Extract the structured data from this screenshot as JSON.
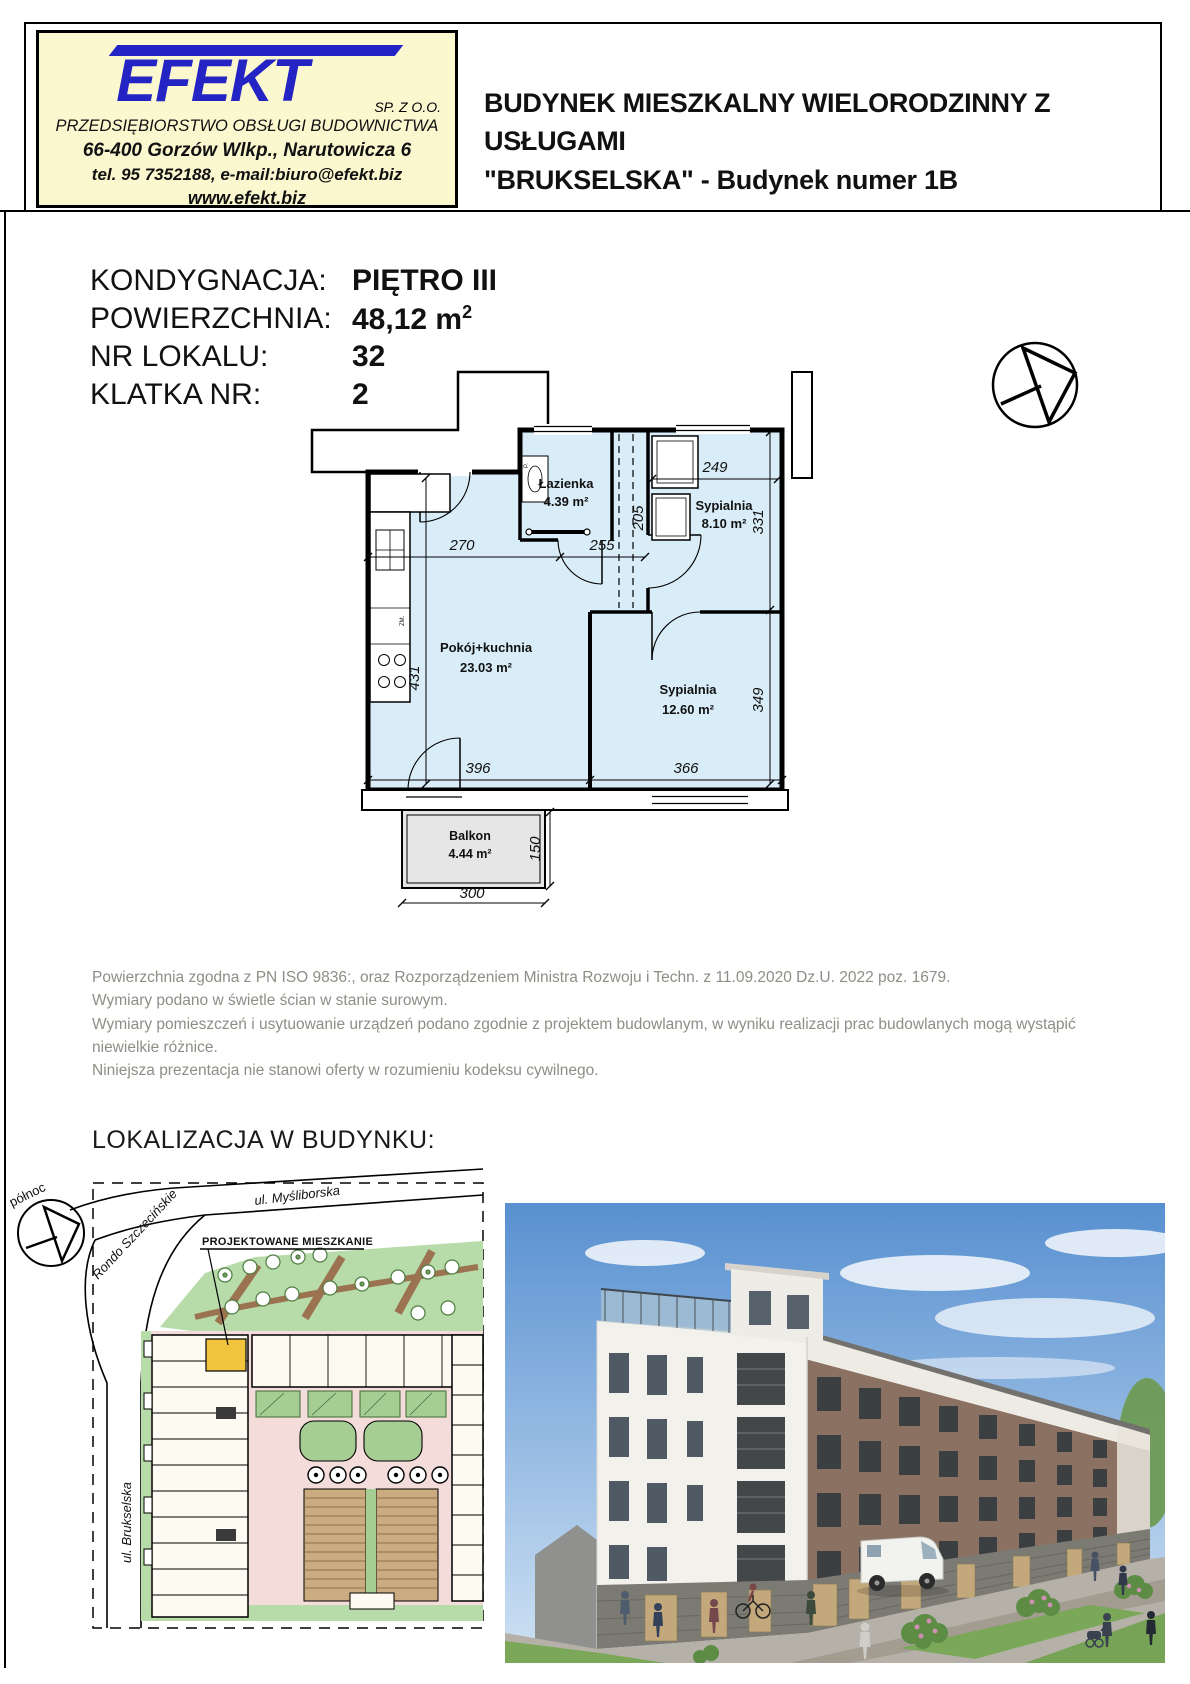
{
  "logo_box": {
    "company": "EFEKT",
    "legal": "SP. Z O.O.",
    "subtitle": "PRZEDSIĘBIORSTWO OBSŁUGI BUDOWNICTWA",
    "address": "66-400 Gorzów Wlkp., Narutowicza 6",
    "contact": "tel. 95 7352188, e-mail:biuro@efekt.biz",
    "website": "www.efekt.biz"
  },
  "header": {
    "title_line1": "BUDYNEK MIESZKALNY WIELORODZINNY Z USŁUGAMI",
    "title_line2": "\"BRUKSELSKA\" - Budynek numer 1B"
  },
  "info": {
    "rows": [
      {
        "label": "KONDYGNACJA:",
        "value": "PIĘTRO III",
        "sup": ""
      },
      {
        "label": "POWIERZCHNIA:",
        "value": "48,12 m",
        "sup": "2"
      },
      {
        "label": "NR LOKALU:",
        "value": "32",
        "sup": ""
      },
      {
        "label": "KLATKA NR:",
        "value": "2",
        "sup": ""
      }
    ]
  },
  "floor_plan": {
    "rooms": [
      {
        "name": "Łazienka",
        "area": "4.39 m²"
      },
      {
        "name": "Sypialnia",
        "area": "8.10 m²"
      },
      {
        "name": "Pokój+kuchnia",
        "area": "23.03 m²"
      },
      {
        "name": "Sypialnia",
        "area": "12.60 m²"
      },
      {
        "name": "Balkon",
        "area": "4.44 m²"
      }
    ],
    "dims": {
      "d270": "270",
      "d255": "255",
      "d205": "205",
      "d249": "249",
      "d331": "331",
      "d431": "431",
      "d396": "396",
      "d366": "366",
      "d349": "349",
      "d300": "300",
      "d150": "150"
    },
    "fixture_labels": {
      "fridge": "ZM.",
      "washer": "P."
    }
  },
  "notes": {
    "lines": [
      "Powierzchnia zgodna z PN ISO 9836:, oraz Rozporządzeniem Ministra Rozwoju i Techn. z 11.09.2020 Dz.U. 2022 poz. 1679.",
      "Wymiary podano w świetle ścian w stanie surowym.",
      "Wymiary pomieszczeń i usytuowanie urządzeń podano zgodnie z projektem budowlanym, w wyniku realizacji prac budowlanych mogą wystąpić niewielkie różnice.",
      "Niniejsza prezentacja nie stanowi oferty w rozumieniu kodeksu cywilnego."
    ]
  },
  "location": {
    "heading": "LOKALIZACJA W BUDYNKU:",
    "compass_label": "północ",
    "street_top": "ul. Myśliborska",
    "street_rondo": "Rondo Szczecińskie",
    "street_left": "ul. Brukselska",
    "callout": "PROJEKTOWANE MIESZKANIE"
  },
  "colors": {
    "logo_blue": "#2424c4",
    "logo_bg": "#fbf8d0",
    "plan_room_fill": "#d9edf8",
    "balcony_fill": "#e6e6e6",
    "site_green": "#b7dcaa",
    "site_unit_highlight": "#f2c43d",
    "site_courtyard_pink": "#f3dcd9",
    "notes_gray": "#8f8d85"
  }
}
